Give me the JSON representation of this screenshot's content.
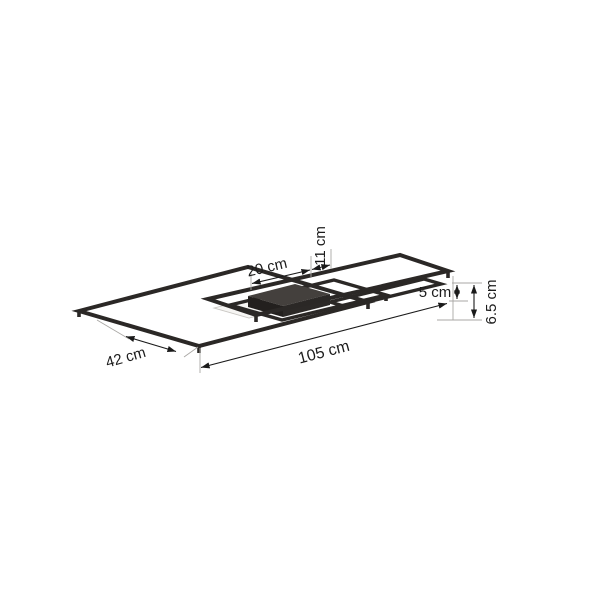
{
  "page": {
    "background": "#ffffff",
    "description": "Product dimension diagram of a rectangular LED ceiling light with overlapping frames, shown in perspective with measurement arrows"
  },
  "diagram": {
    "dimensions": {
      "canopy_width": "20 cm",
      "offset": "11 cm",
      "frame_height": "5 cm",
      "total_height": "6.5 cm",
      "total_length": "105 cm",
      "total_depth": "42 cm"
    },
    "colors": {
      "frame": "#2b2826",
      "canopy_top": "#44403d",
      "canopy_side_dark": "#23201e",
      "canopy_side": "#2c2927",
      "light_panel": "#f6f5f3",
      "dimension_line": "#1a1a1a",
      "extension_line": "#a9a7a4"
    }
  }
}
